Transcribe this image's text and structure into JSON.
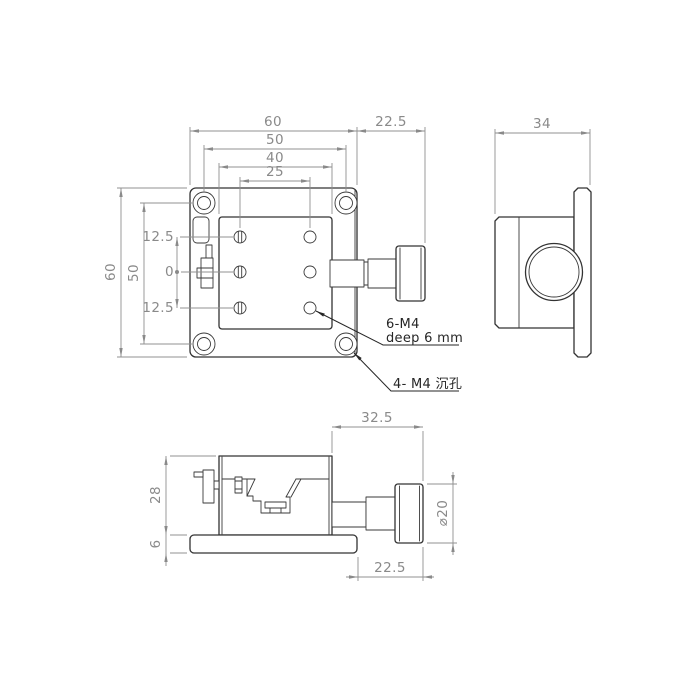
{
  "dims": {
    "front": {
      "width": "60",
      "hole_span_h": "50",
      "platform_width": "40",
      "hole_col_span": "25",
      "knob_offset": "22.5",
      "height": "60",
      "hole_span_v": "50",
      "row_upper": "12.5",
      "row_center": "0",
      "row_lower": "12.5"
    },
    "side": {
      "depth": "34"
    },
    "bottom": {
      "knob_length": "32.5",
      "body_height": "28",
      "base_height": "6",
      "knob_clearance": "22.5",
      "knob_diameter": "⌀20"
    }
  },
  "annotations": {
    "tapped_holes_line1": "6-M4",
    "tapped_holes_line2": "deep 6 mm",
    "counterbore_holes": "4- M4 沉孔"
  },
  "colors": {
    "edge": "#333333",
    "dimension": "#909090",
    "dimension_text": "#8a8a8a",
    "annotation_text": "#262626"
  }
}
